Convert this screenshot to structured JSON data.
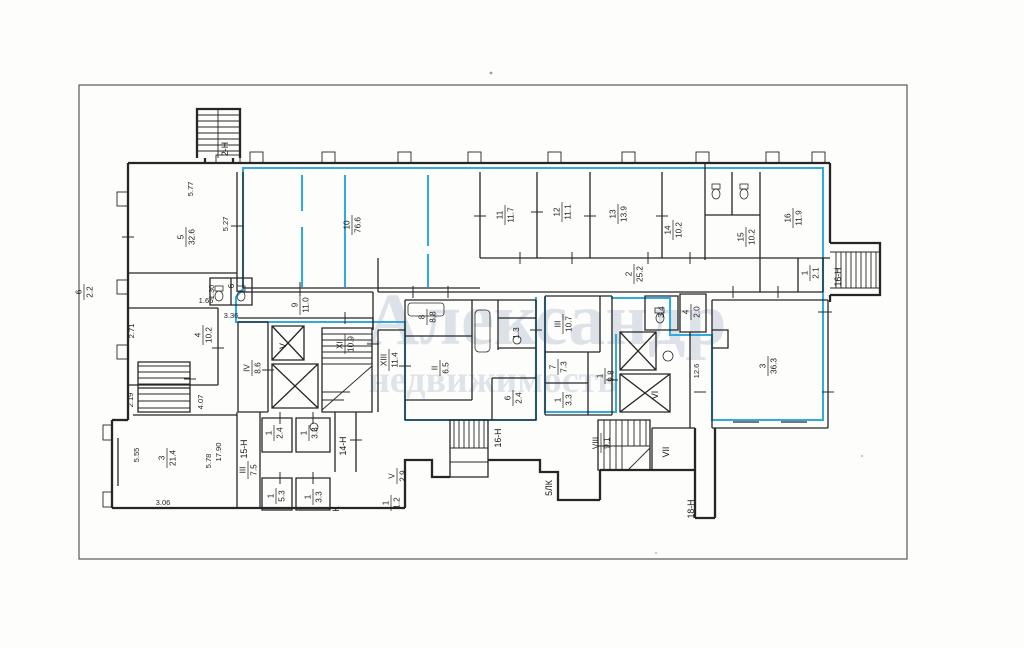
{
  "document": {
    "type": "floor-plan-scan"
  },
  "colors": {
    "highlight": "#35a9da",
    "wall": "#262626",
    "watermark": "#b2bfce",
    "frame": "#4a4a4a"
  },
  "watermark": {
    "line1": "Александр",
    "line2": "недвижимость"
  },
  "rooms": {
    "r5": {
      "num": "5",
      "area": "32.6"
    },
    "r10": {
      "num": "10",
      "area": "76.6"
    },
    "r11": {
      "num": "11",
      "area": "11.7"
    },
    "r12": {
      "num": "12",
      "area": "11.1"
    },
    "r13": {
      "num": "13",
      "area": "13.9"
    },
    "r14": {
      "num": "14",
      "area": "10.2"
    },
    "r15": {
      "num": "15",
      "area": "10.2"
    },
    "r16": {
      "num": "16",
      "area": "11.9"
    },
    "r1_small": {
      "num": "1",
      "area": "2.1"
    },
    "r2_corr": {
      "num": "2",
      "area": "25.2"
    },
    "r9": {
      "num": "9",
      "area": "11.0"
    },
    "r4_left": {
      "num": "4",
      "area": "10.2"
    },
    "r6_wc": {
      "num": "6"
    },
    "r6_ext": {
      "num": "6",
      "area": "2.2"
    },
    "r3_left": {
      "num": "3",
      "area": "21.4"
    },
    "r3_right": {
      "num": "3",
      "area": "36.3"
    },
    "r4_small": {
      "num": "4",
      "area": "2.0"
    },
    "r8": {
      "num": "8",
      "area": "8.8"
    },
    "rII_65": {
      "num": "II",
      "area": "6.5"
    },
    "r1_3": {
      "area": "1.3"
    },
    "r6_24": {
      "num": "6",
      "area": "2.4"
    },
    "rIII_107": {
      "num": "III",
      "area": "10.7"
    },
    "r7_73": {
      "num": "7",
      "area": "7.3"
    },
    "r1_33a": {
      "num": "1",
      "area": "3.3"
    },
    "r1_98": {
      "num": "1",
      "area": "9.8"
    },
    "r3_4": {
      "area": "3.4"
    },
    "rIV_86": {
      "num": "IV",
      "area": "8.6"
    },
    "rXII_109": {
      "num": "XII",
      "area": "10.9"
    },
    "rXIII_114": {
      "num": "XIII",
      "area": "11.4"
    },
    "rV_29": {
      "num": "V",
      "area": "2.9"
    },
    "r1_12": {
      "num": "1",
      "area": "1.2"
    },
    "rIII_75": {
      "num": "III",
      "area": "7.5"
    },
    "r1_24": {
      "num": "1",
      "area": "2.4"
    },
    "r1_33b": {
      "num": "1",
      "area": "3.3"
    },
    "r1_53": {
      "num": "1",
      "area": "5.3"
    },
    "r1_33c": {
      "num": "1",
      "area": "3.3"
    },
    "rVIII_91": {
      "num": "VIII",
      "area": "9.1"
    }
  },
  "elevators": {
    "v": "V",
    "vi": "VI",
    "vii": "VII"
  },
  "annotations": {
    "a2n": "2-Н",
    "a16nR": "16-Н",
    "a16nB": "16-Н",
    "a15n": "15-Н",
    "a14n": "14-Н",
    "a18n": "18-Н",
    "a5lk": "5ЛК",
    "aK": "К"
  },
  "dims": {
    "d577": "5.77",
    "d527": "5.27",
    "d130": "1.30",
    "d165": "1.65",
    "d336": "3.36",
    "d271": "2.71",
    "d219": "2.19",
    "d407": "4.07",
    "d555": "5.55",
    "d306": "3.06",
    "d578": "5.78",
    "d1790": "17.90",
    "d126": "12.6"
  }
}
